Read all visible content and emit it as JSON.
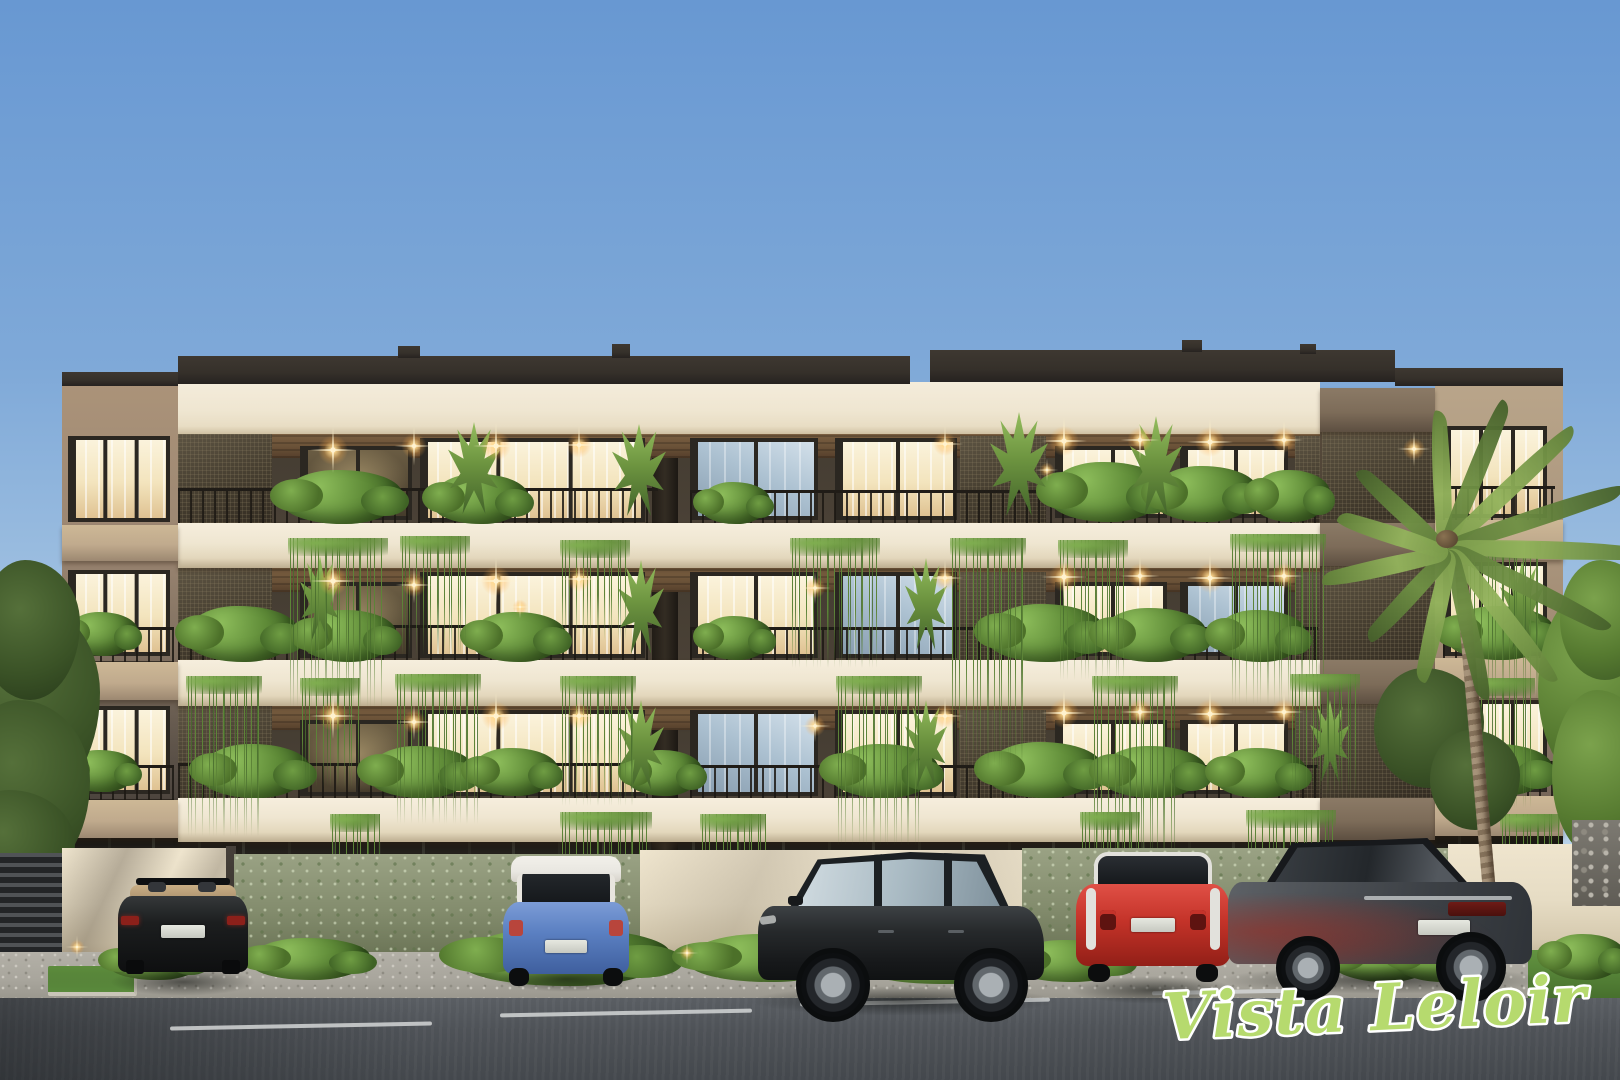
{
  "title": "Vista Leloir apartment building — exterior architectural rendering",
  "watermark": {
    "text": "Vista Leloir"
  },
  "scene": {
    "type": "photorealistic exterior render, street elevation at dusk",
    "subject": "four-storey residential building with cream slab bands, dark bronze window frames, mesh balcony screens, planted balconies with hanging vines, perimeter wall, five parked cars, palm tree",
    "vehicles": [
      "dark convertible",
      "blue hatchback with white roof",
      "dark grey SUV",
      "red city car with white trim",
      "grey sedan"
    ]
  },
  "palette": {
    "sky_top": "#6898d2",
    "sky_mid": "#a3c3e2",
    "sky_low": "#c0d7eb",
    "cream": "#efe6d1",
    "roof_dark": "#35302a",
    "frame": "#2b2721",
    "green_mid": "#5d8438",
    "green_light": "#7fae4f",
    "wall_cream": "#e6dcc4",
    "gravel": "#a8a59c",
    "road": "#4e5257",
    "grass_bright": "#5c8a3a",
    "light_warm": "#ffd98f",
    "logo_green": "#b6da6e",
    "audi_body": "#1c1e1f",
    "audi_interior": "#c9ae85",
    "mini_body": "#5b80c2",
    "mini_roof": "#e9e7e1",
    "suv_body": "#26292b",
    "smart_body": "#c43329",
    "smart_trim": "#e2e1dc",
    "sedan_body": "#4a4e53"
  }
}
